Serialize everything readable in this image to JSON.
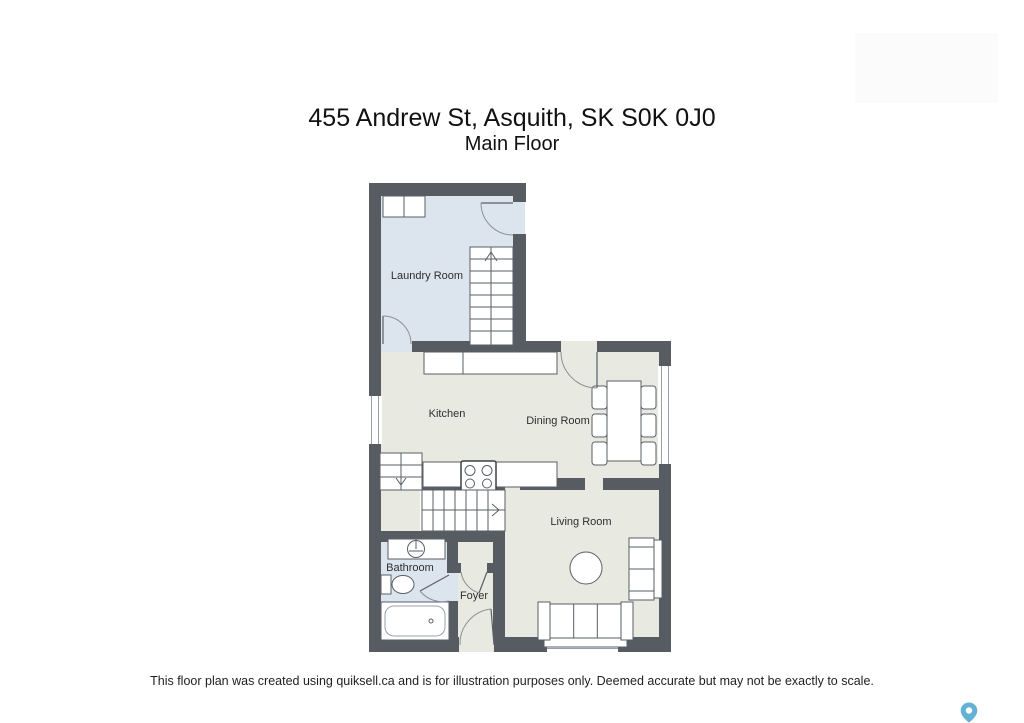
{
  "page": {
    "title": "455 Andrew St, Asquith, SK S0K 0J0",
    "subtitle": "Main Floor",
    "disclaimer": "This floor plan was created using quiksell.ca and is for illustration purposes only. Deemed accurate but may not be exactly to scale."
  },
  "rooms": {
    "laundry": "Laundry Room",
    "kitchen": "Kitchen",
    "dining": "Dining Room",
    "living": "Living Room",
    "bathroom": "Bathroom",
    "foyer": "Foyer"
  },
  "colors": {
    "wall": "#575c63",
    "floor_main": "#e8e9e0",
    "floor_wet": "#dce4ee",
    "pin": "#63b1d4"
  },
  "icons": {
    "map_pin": "location-pin teardrop with white dot"
  }
}
